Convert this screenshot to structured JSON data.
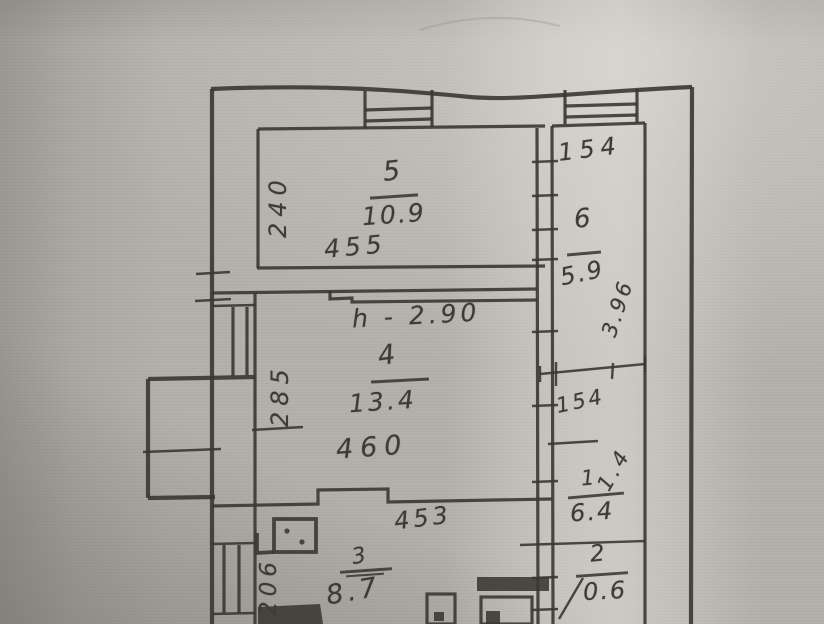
{
  "document": {
    "kind": "scanned hand-drawn apartment floor plan",
    "paper_color": "#b3b0aa",
    "ink_color": "#3a3731"
  },
  "labels": {
    "room5": {
      "number": "5",
      "area": "10.9",
      "width": "455",
      "depth": "240"
    },
    "room6": {
      "number": "6",
      "area": "5.9",
      "width": "154",
      "depth": "3.96"
    },
    "room4": {
      "number": "4",
      "area": "13.4",
      "width": "460",
      "depth": "285",
      "ceiling_height": "h - 2.90"
    },
    "hall1": {
      "number": "1",
      "area": "6.4",
      "dim_a": "154",
      "dim_b": "1.4"
    },
    "room3": {
      "number": "3",
      "area": "8.7",
      "width": "453",
      "depth": "206"
    },
    "room2": {
      "number": "2",
      "area": "0.6"
    }
  }
}
